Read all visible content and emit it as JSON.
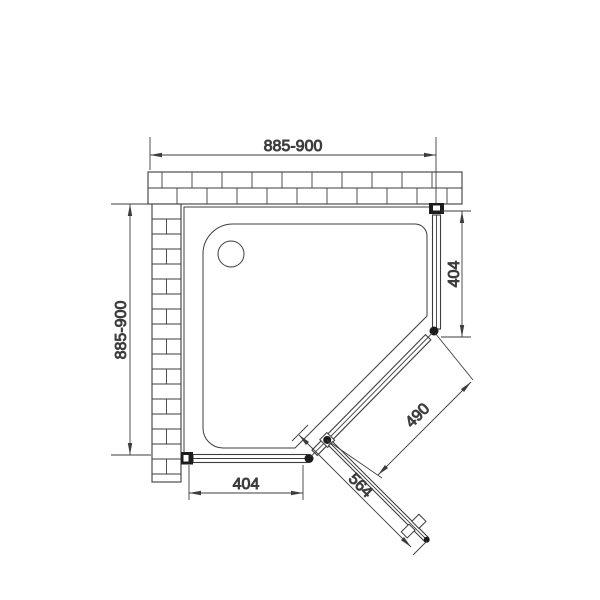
{
  "drawing": {
    "dimensions": {
      "width_top": "885-900",
      "depth_left": "885-900",
      "panel_right": "404",
      "panel_bottom": "404",
      "door_diagonal": "490",
      "door_width": "564"
    },
    "colors": {
      "line": "#3d3d3d",
      "dark": "#1c1c1c",
      "background": "#ffffff"
    }
  }
}
